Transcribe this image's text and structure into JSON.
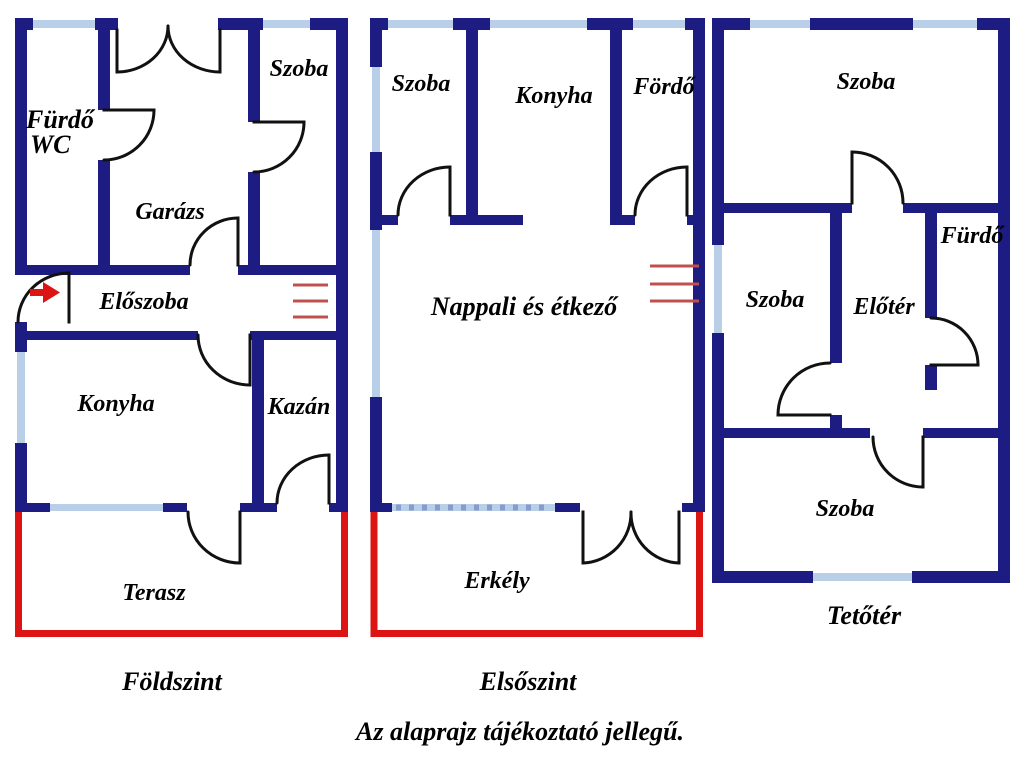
{
  "colors": {
    "wall": "#1c1c82",
    "window": "#b9cfe8",
    "outdoor": "#dd1414",
    "stairs": "#c0504d",
    "door": "#111111",
    "text": "#000000",
    "bg": "#ffffff"
  },
  "floors": {
    "ground": {
      "title": "Földszint",
      "rooms": {
        "furdo_line1": "Fürdő",
        "furdo_line2": "WC",
        "szoba": "Szoba",
        "garazs": "Garázs",
        "eloszoba": "Előszoba",
        "konyha": "Konyha",
        "kazan": "Kazán",
        "terasz": "Terasz"
      }
    },
    "first": {
      "title": "Elsőszint",
      "rooms": {
        "szoba": "Szoba",
        "konyha": "Konyha",
        "fordo": "Fördő",
        "nappali": "Nappali és étkező",
        "erkely": "Erkély"
      }
    },
    "attic": {
      "title": "Tetőtér",
      "rooms": {
        "szoba_top": "Szoba",
        "szoba_left": "Szoba",
        "eloter": "Előtér",
        "furdo": "Fürdő",
        "szoba_bottom": "Szoba"
      }
    }
  },
  "footer": {
    "disclaimer": "Az alaprajz tájékoztató jellegű."
  }
}
